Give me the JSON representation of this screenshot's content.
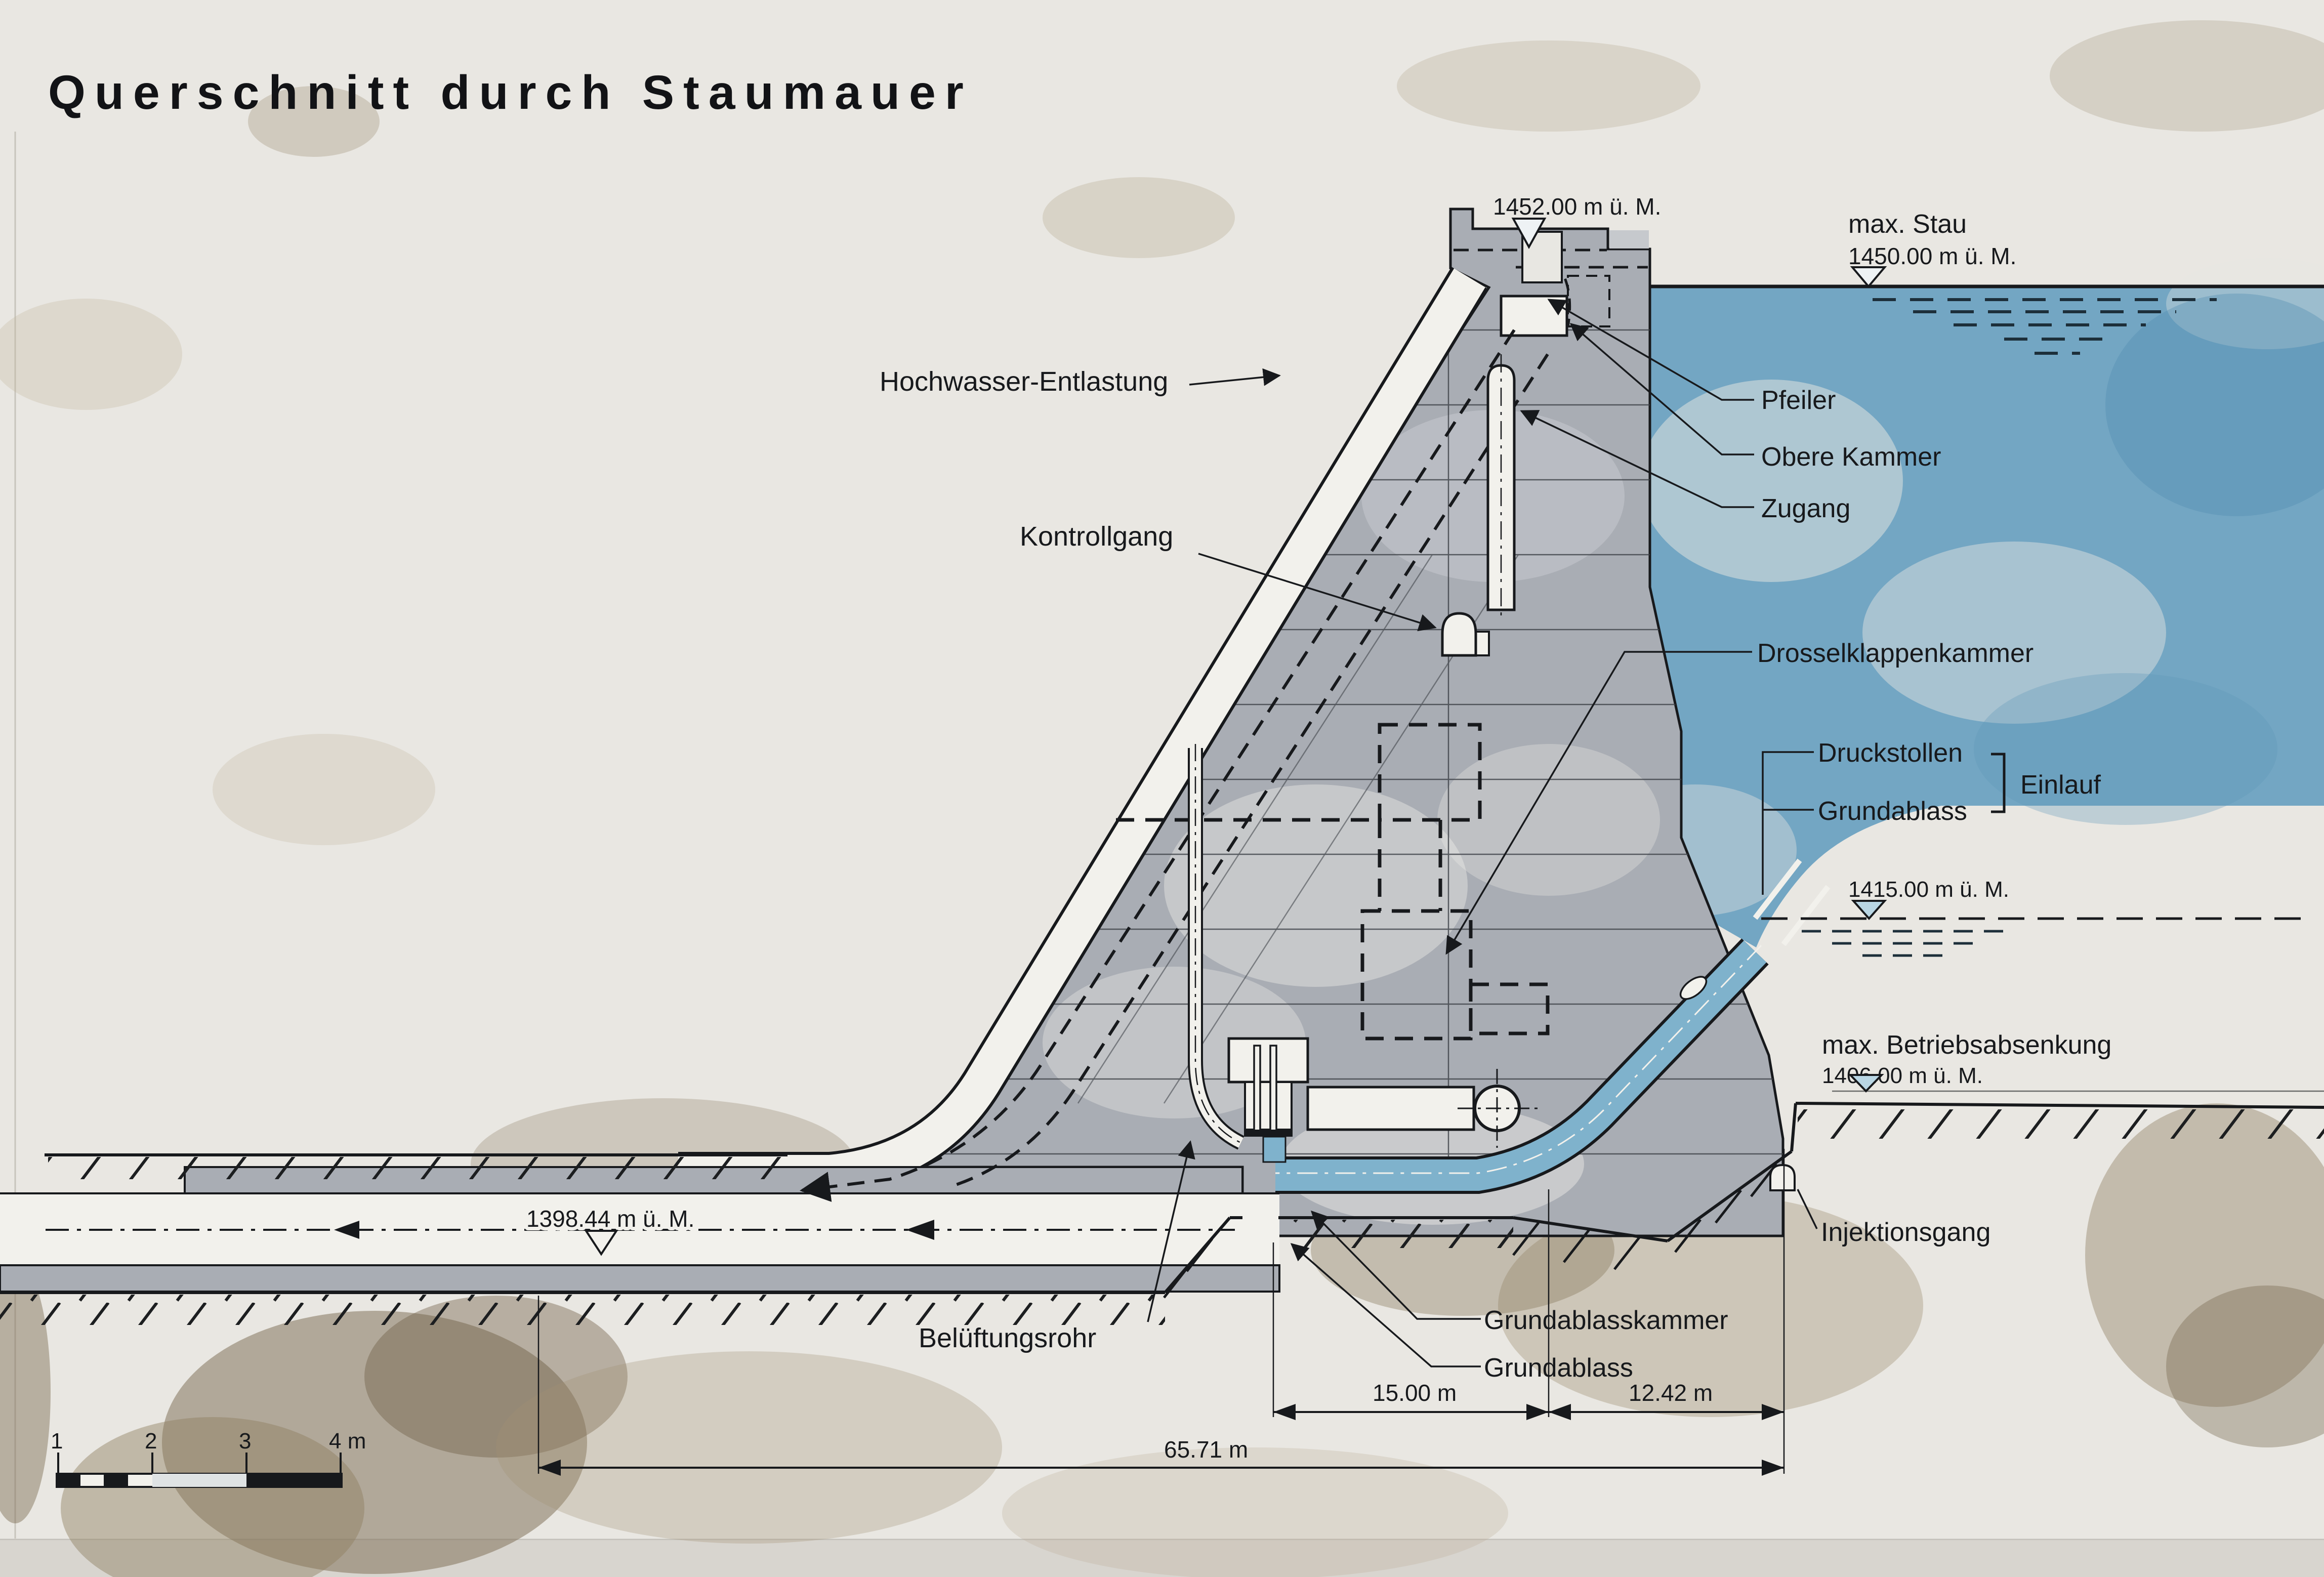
{
  "title": "Querschnitt durch Staumauer",
  "annotations": {
    "hochwasser": "Hochwasser-Entlastung",
    "kontrollgang": "Kontrollgang",
    "pfeiler": "Pfeiler",
    "obere_kammer": "Obere Kammer",
    "zugang": "Zugang",
    "drosselklappenkammer": "Drosselklappenkammer",
    "druckstollen": "Druckstollen",
    "einlauf": "Einlauf",
    "grundablass_right": "Grundablass",
    "injektionsgang": "Injektionsgang",
    "grundablasskammer": "Grundablasskammer",
    "grundablass_bottom": "Grundablass",
    "belueftungsrohr": "Belüftungsrohr"
  },
  "elevations": {
    "crest": "1452.00 m ü. M.",
    "max_stau_label": "max. Stau",
    "max_stau_value": "1450.00 m ü. M.",
    "level_1415": "1415.00 m ü. M.",
    "max_betrieb_label": "max. Betriebsabsenkung",
    "max_betrieb_value": "1406.00 m ü. M.",
    "outlet": "1398.44 m ü. M."
  },
  "dimensions": {
    "d_15": "15.00 m",
    "d_1242": "12.42 m",
    "d_6571": "65.71 m"
  },
  "scalebar": {
    "m1": "1",
    "m2": "2",
    "m3": "3",
    "m4": "4 m"
  },
  "colors": {
    "background": "#e9e7e2",
    "water": "#73a6c3",
    "pipe_water": "#7fb2cc",
    "concrete": "#a9adb4",
    "concrete_light": "#c6c9cd",
    "surface_white": "#f2f1ec",
    "line": "#17191c",
    "triangle_water": "#b9d6e4"
  }
}
